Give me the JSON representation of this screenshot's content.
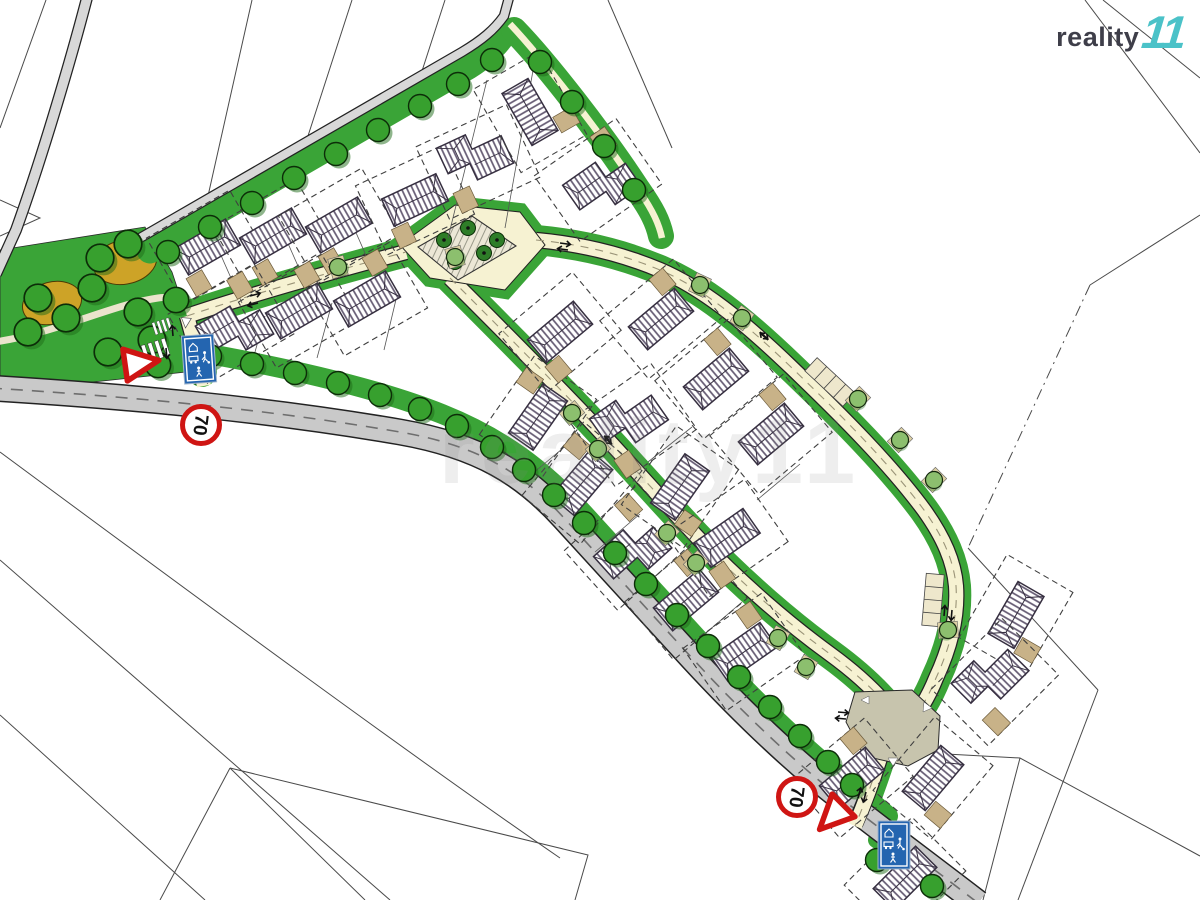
{
  "branding": {
    "logo_text": "reality",
    "logo_mark": "11"
  },
  "watermark": {
    "text": "reality11"
  },
  "traffic_signs": {
    "west_speed_limit_value": "70",
    "south_speed_limit_value": "70",
    "west_yield": "yield-sign",
    "south_yield": "yield-sign",
    "west_residential_zone": "residential-zone-sign",
    "south_residential_zone": "residential-zone-sign"
  },
  "features": {
    "kind": "residential-development-site-plan",
    "park": "park-with-trees",
    "playground": "central-hatched-square-with-trees",
    "houses_count": 27,
    "trees_count": 46,
    "crosswalks_count": 2,
    "parking_strips_count": 2
  },
  "palette": {
    "verge_green": "#3aa437",
    "tree_green": "#37a02e",
    "main_road_gray": "#c9c9c9",
    "lane_cream": "#f6f2d2",
    "driveway_tan": "#c8b288",
    "sign_red": "#cf1513",
    "sign_blue": "#2465b0",
    "ochre": "#cda327"
  }
}
